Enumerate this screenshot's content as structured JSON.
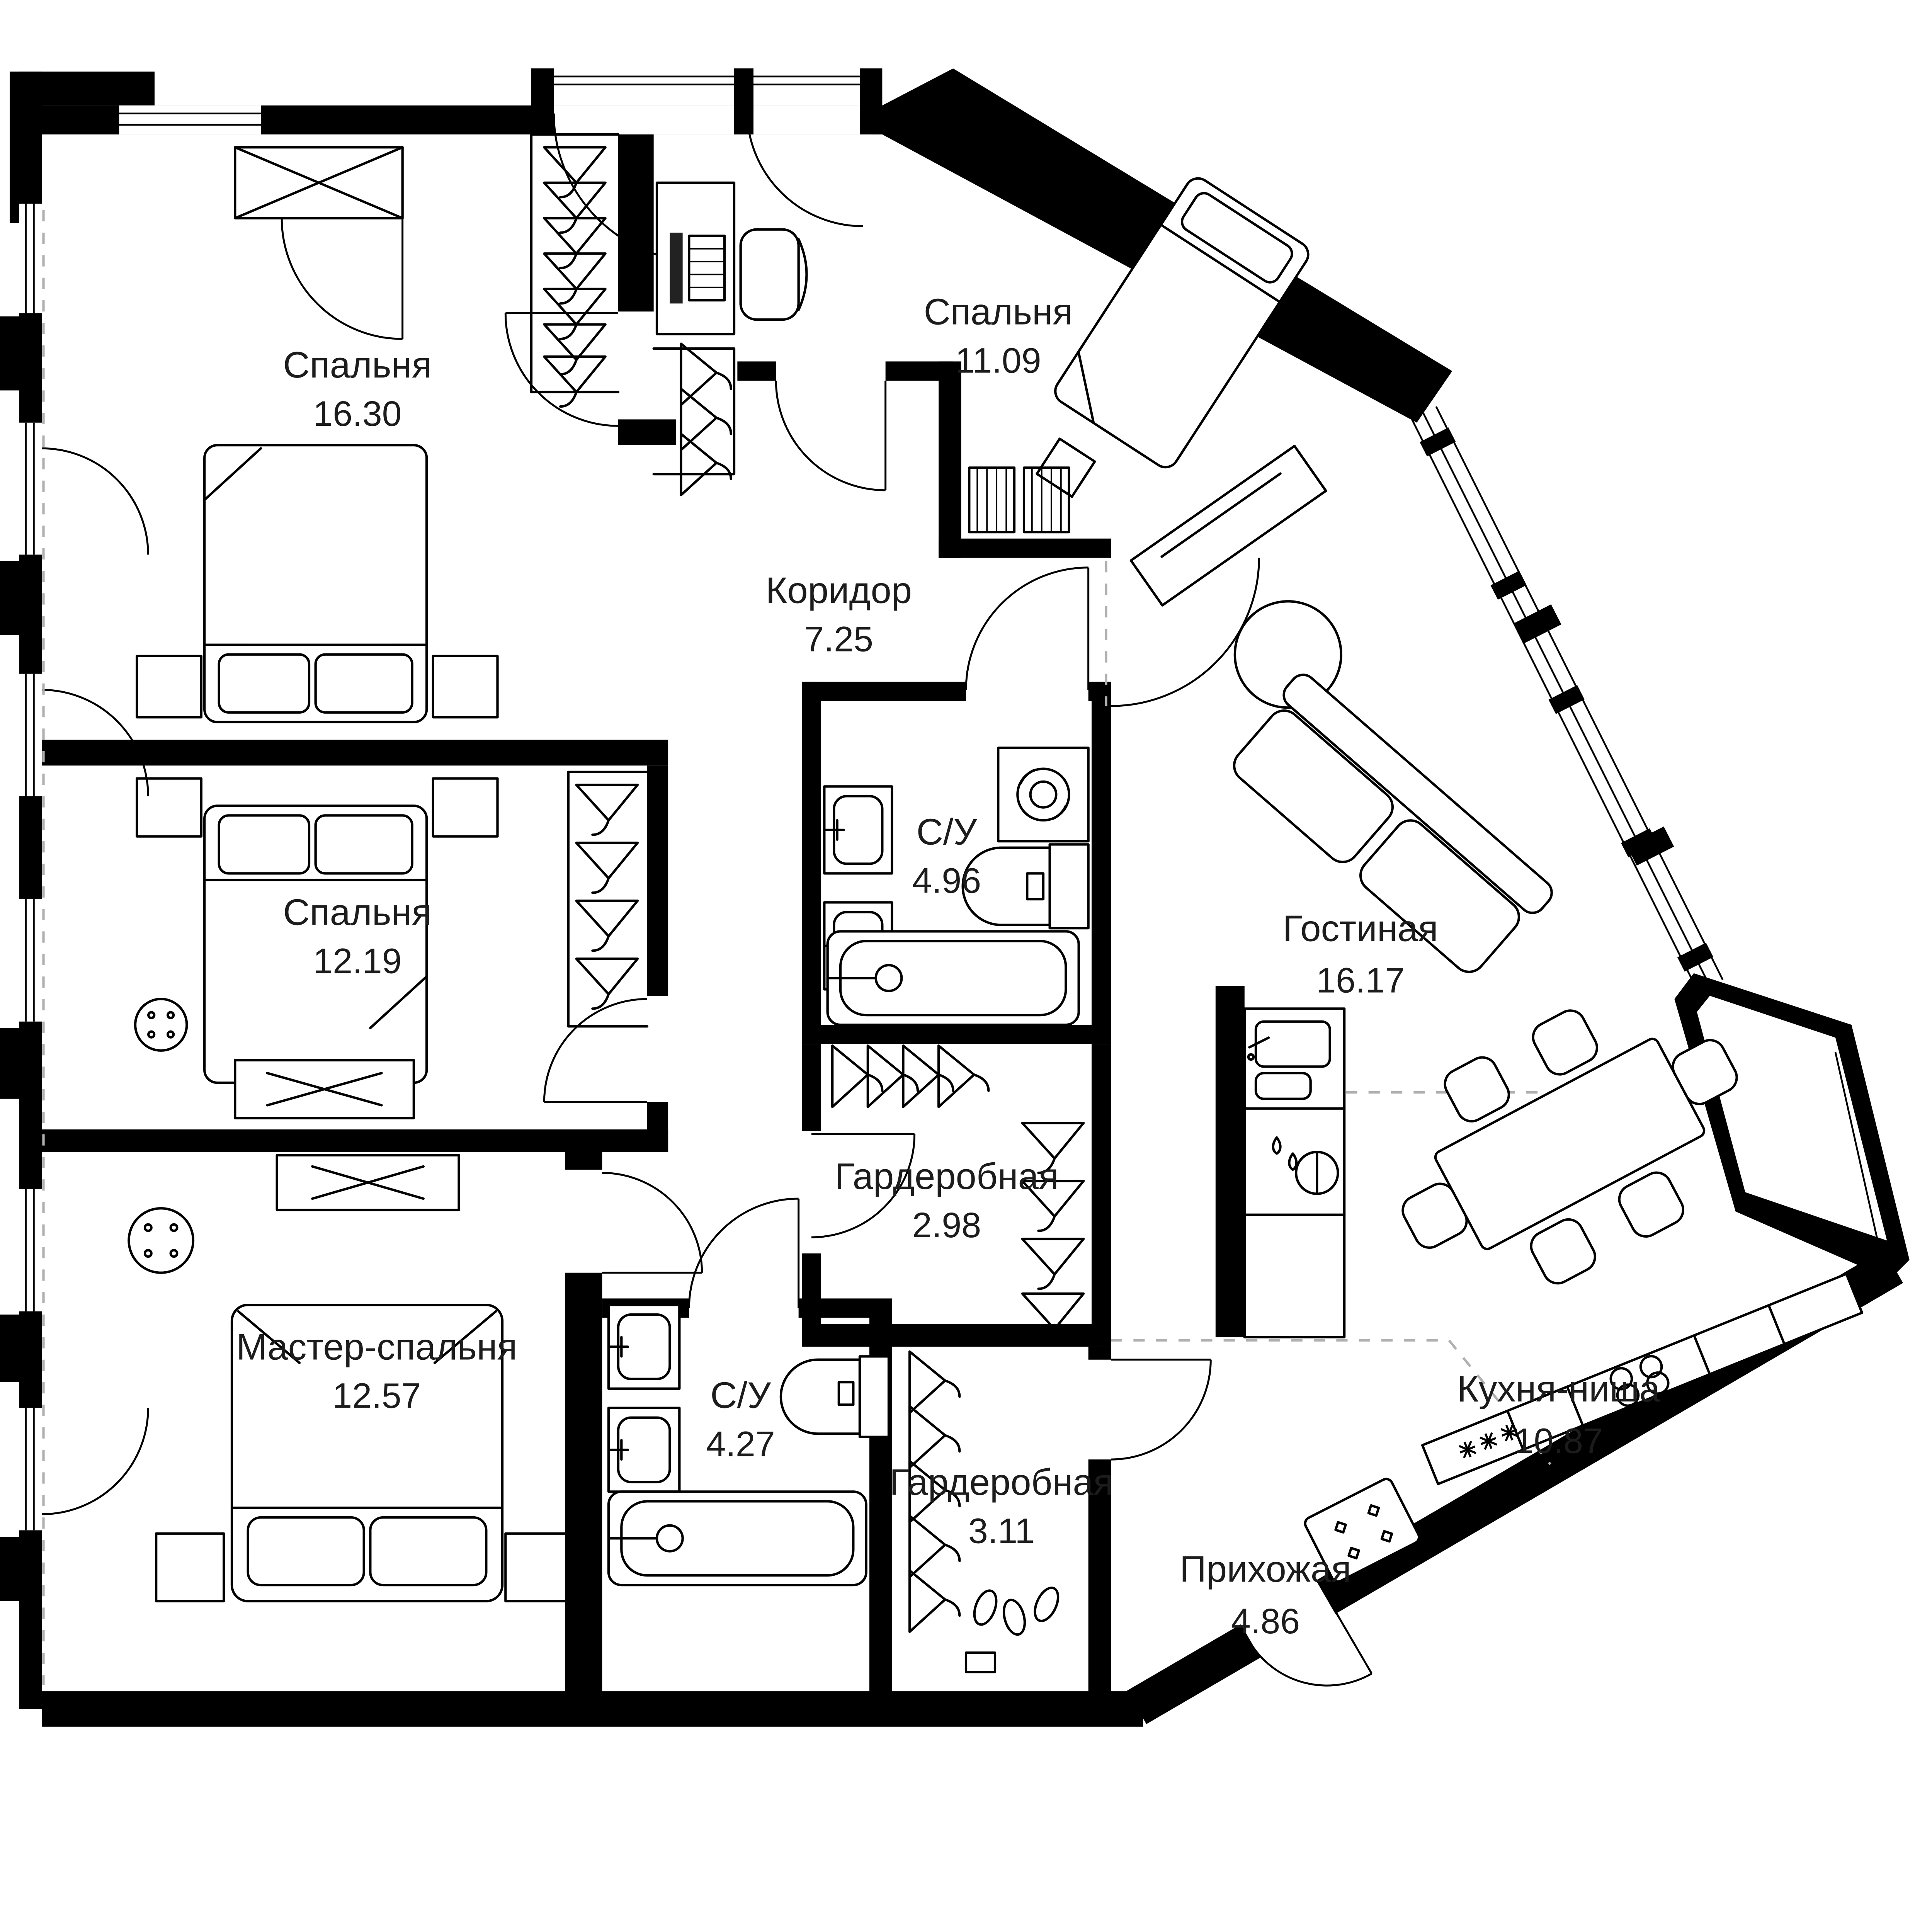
{
  "plan": {
    "background": "#ffffff",
    "wall_color": "#000000",
    "line_color": "#1c1c1c",
    "dashed_color": "#b0b0b0",
    "rooms": [
      {
        "id": "bedroom-1",
        "name": "Спальня",
        "area": "16.30"
      },
      {
        "id": "bedroom-2",
        "name": "Спальня",
        "area": "11.09"
      },
      {
        "id": "corridor",
        "name": "Коридор",
        "area": "7.25"
      },
      {
        "id": "bedroom-3",
        "name": "Спальня",
        "area": "12.19"
      },
      {
        "id": "bathroom-1",
        "name": "С/У",
        "area": "4.96"
      },
      {
        "id": "living-room",
        "name": "Гостиная",
        "area": "16.17"
      },
      {
        "id": "wardrobe-1",
        "name": "Гардеробная",
        "area": "2.98"
      },
      {
        "id": "master-bedroom",
        "name": "Мастер-спальня",
        "area": "12.57"
      },
      {
        "id": "bathroom-2",
        "name": "С/У",
        "area": "4.27"
      },
      {
        "id": "wardrobe-2",
        "name": "Гардеробная",
        "area": "3.11"
      },
      {
        "id": "kitchen-niche",
        "name": "Кухня-ниша",
        "area": "10.87"
      },
      {
        "id": "hallway",
        "name": "Прихожая",
        "area": "4.86"
      }
    ]
  }
}
